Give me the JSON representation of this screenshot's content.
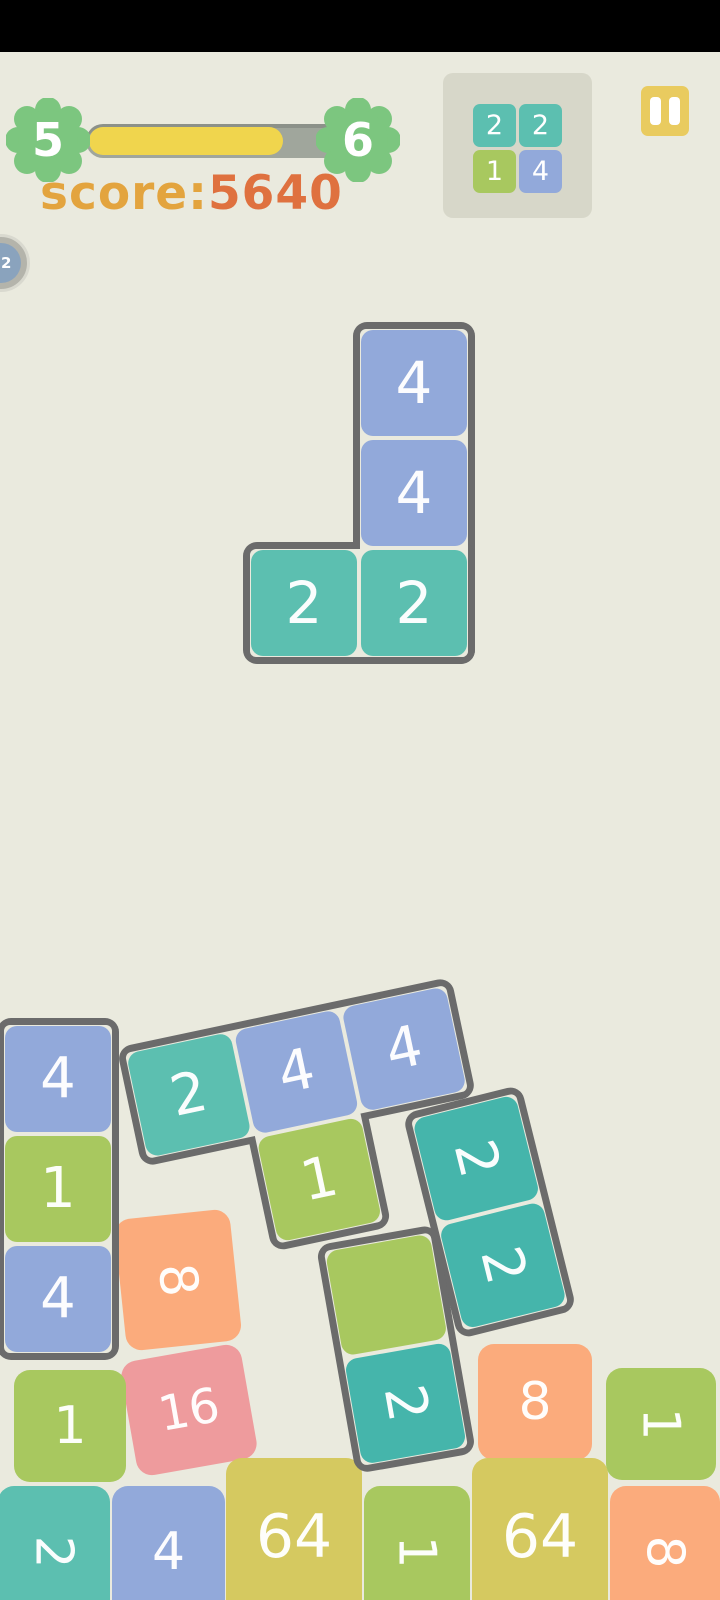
{
  "hud": {
    "level_current": "5",
    "level_next": "6",
    "progress_percent": 72,
    "score_label": "score:",
    "score_value": "5640",
    "badge_value": "22",
    "next_piece_tiles": [
      {
        "value": "2",
        "color": "teal"
      },
      {
        "value": "2",
        "color": "teal"
      },
      {
        "value": "1",
        "color": "green"
      },
      {
        "value": "4",
        "color": "blue"
      }
    ]
  },
  "colors": {
    "background": "#eaeade",
    "status_bar": "#000000",
    "piece_border": "#6b6b6b",
    "progress_track": "#a0a69c",
    "progress_fill": "#f0d54d",
    "flower_badge": "#7cc67f",
    "score_label": "#e3a43e",
    "score_value": "#df713f",
    "preview_bg": "#d7d7c9",
    "pause_button": "#e9cb5f",
    "tile": {
      "blue": "#92a9da",
      "teal": "#5cbfb0",
      "teal_deep": "#45b5ab",
      "green": "#a8c85f",
      "orange": "#fbab7c",
      "pink": "#ee9b9d",
      "yellow": "#d5c960"
    }
  },
  "board": {
    "pieces": [
      {
        "name": "falling-piece",
        "interactable": true,
        "x": 361,
        "y": 330,
        "rotate": 0,
        "blocks": [
          {
            "x": 0,
            "y": 0,
            "w": 106,
            "h": 326
          },
          {
            "x": -110,
            "y": 220,
            "w": 216,
            "h": 106
          }
        ],
        "tiles": [
          {
            "value": "4",
            "color": "blue",
            "x": 0,
            "y": 0,
            "fs": 58
          },
          {
            "value": "4",
            "color": "blue",
            "x": 0,
            "y": 110,
            "fs": 58
          },
          {
            "value": "2",
            "color": "teal",
            "x": 0,
            "y": 220,
            "fs": 58
          },
          {
            "value": "2",
            "color": "teal",
            "x": -110,
            "y": 220,
            "fs": 58
          }
        ]
      },
      {
        "name": "stack-piece-left-column",
        "interactable": false,
        "x": 5,
        "y": 1026,
        "rotate": 0,
        "blocks": [
          {
            "x": 0,
            "y": 0,
            "w": 106,
            "h": 326
          }
        ],
        "tiles": [
          {
            "value": "4",
            "color": "blue",
            "x": 0,
            "y": 0,
            "fs": 56
          },
          {
            "value": "1",
            "color": "green",
            "x": 0,
            "y": 110,
            "fs": 56
          },
          {
            "value": "4",
            "color": "blue",
            "x": 0,
            "y": 220,
            "fs": 56
          }
        ]
      },
      {
        "name": "stack-piece-t-shape",
        "interactable": false,
        "x": 126,
        "y": 1054,
        "rotate": -12,
        "blocks": [
          {
            "x": 0,
            "y": 0,
            "w": 326,
            "h": 106
          },
          {
            "x": 110,
            "y": 100,
            "w": 106,
            "h": 116
          }
        ],
        "tiles": [
          {
            "value": "2",
            "color": "teal",
            "x": 0,
            "y": 0,
            "fs": 56
          },
          {
            "value": "4",
            "color": "blue",
            "x": 110,
            "y": 0,
            "fs": 56
          },
          {
            "value": "4",
            "color": "blue",
            "x": 220,
            "y": 0,
            "fs": 56
          },
          {
            "value": "1",
            "color": "green",
            "x": 110,
            "y": 110,
            "fs": 56
          }
        ]
      },
      {
        "name": "stack-piece-teal-domino",
        "interactable": false,
        "x": 412,
        "y": 1120,
        "rotate": -14,
        "blocks": [
          {
            "x": 0,
            "y": 0,
            "w": 106,
            "h": 216
          }
        ],
        "tiles": [
          {
            "value": "2",
            "color": "teal_deep",
            "x": 0,
            "y": 0,
            "fs": 56,
            "text_rotate": 90
          },
          {
            "value": "2",
            "color": "teal_deep",
            "x": 0,
            "y": 110,
            "fs": 56,
            "text_rotate": 90
          }
        ]
      },
      {
        "name": "stack-piece-green-domino",
        "interactable": false,
        "x": 325,
        "y": 1252,
        "rotate": -10,
        "blocks": [
          {
            "x": 0,
            "y": 0,
            "w": 106,
            "h": 216
          }
        ],
        "tiles": [
          {
            "value": "",
            "color": "green",
            "x": 0,
            "y": 0,
            "fs": 56
          },
          {
            "value": "2",
            "color": "teal_deep",
            "x": 0,
            "y": 110,
            "fs": 56,
            "text_rotate": 90
          }
        ]
      }
    ],
    "loose_tiles": [
      {
        "value": "8",
        "color": "orange",
        "x": 120,
        "y": 1214,
        "w": 116,
        "h": 132,
        "rotate": -6,
        "text_rotate": 90,
        "fs": 52
      },
      {
        "value": "16",
        "color": "pink",
        "x": 128,
        "y": 1352,
        "w": 122,
        "h": 116,
        "rotate": -10,
        "fs": 48
      },
      {
        "value": "1",
        "color": "green",
        "x": 14,
        "y": 1370,
        "w": 112,
        "h": 112,
        "fs": 52
      },
      {
        "value": "8",
        "color": "orange",
        "x": 478,
        "y": 1344,
        "w": 114,
        "h": 116,
        "fs": 52
      },
      {
        "value": "1",
        "color": "green",
        "x": 606,
        "y": 1368,
        "w": 110,
        "h": 112,
        "text_rotate": 90,
        "fs": 52
      },
      {
        "value": "2",
        "color": "teal",
        "x": -2,
        "y": 1486,
        "w": 112,
        "h": 132,
        "text_rotate": 90,
        "fs": 52
      },
      {
        "value": "4",
        "color": "blue",
        "x": 112,
        "y": 1486,
        "w": 113,
        "h": 132,
        "fs": 52
      },
      {
        "value": "64",
        "color": "yellow",
        "x": 226,
        "y": 1458,
        "w": 136,
        "h": 158,
        "fs": 60
      },
      {
        "value": "1",
        "color": "green",
        "x": 364,
        "y": 1486,
        "w": 106,
        "h": 132,
        "text_rotate": 90,
        "fs": 52
      },
      {
        "value": "64",
        "color": "yellow",
        "x": 472,
        "y": 1458,
        "w": 136,
        "h": 158,
        "fs": 60
      },
      {
        "value": "8",
        "color": "orange",
        "x": 610,
        "y": 1486,
        "w": 110,
        "h": 132,
        "text_rotate": 90,
        "fs": 52
      }
    ]
  }
}
